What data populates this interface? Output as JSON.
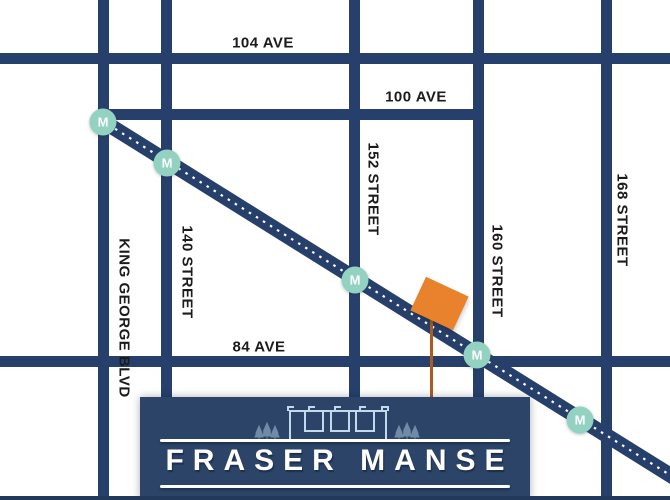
{
  "map": {
    "avenues": [
      {
        "label": "104 AVE"
      },
      {
        "label": "100 AVE"
      },
      {
        "label": "84 AVE"
      }
    ],
    "streets": [
      {
        "label": "KING GEORGE BLVD"
      },
      {
        "label": "140 STREET"
      },
      {
        "label": "152 STREET"
      },
      {
        "label": "160 STREET"
      },
      {
        "label": "168 STREET"
      }
    ],
    "transit": {
      "stations": [
        {
          "label": "M"
        },
        {
          "label": "M"
        },
        {
          "label": "M"
        },
        {
          "label": "M"
        },
        {
          "label": "M"
        }
      ]
    }
  },
  "banner": {
    "title": "FRASER MANSE"
  },
  "colors": {
    "road_navy": "#27406b",
    "banner_navy": "#2b4468",
    "station_mint": "#93d2c0",
    "marker_orange": "#e8822c",
    "marker_pole": "#aa5c20",
    "label_black": "#1b1b1b",
    "illustration_blue": "#c3d9ee",
    "text_white": "#ffffff"
  }
}
